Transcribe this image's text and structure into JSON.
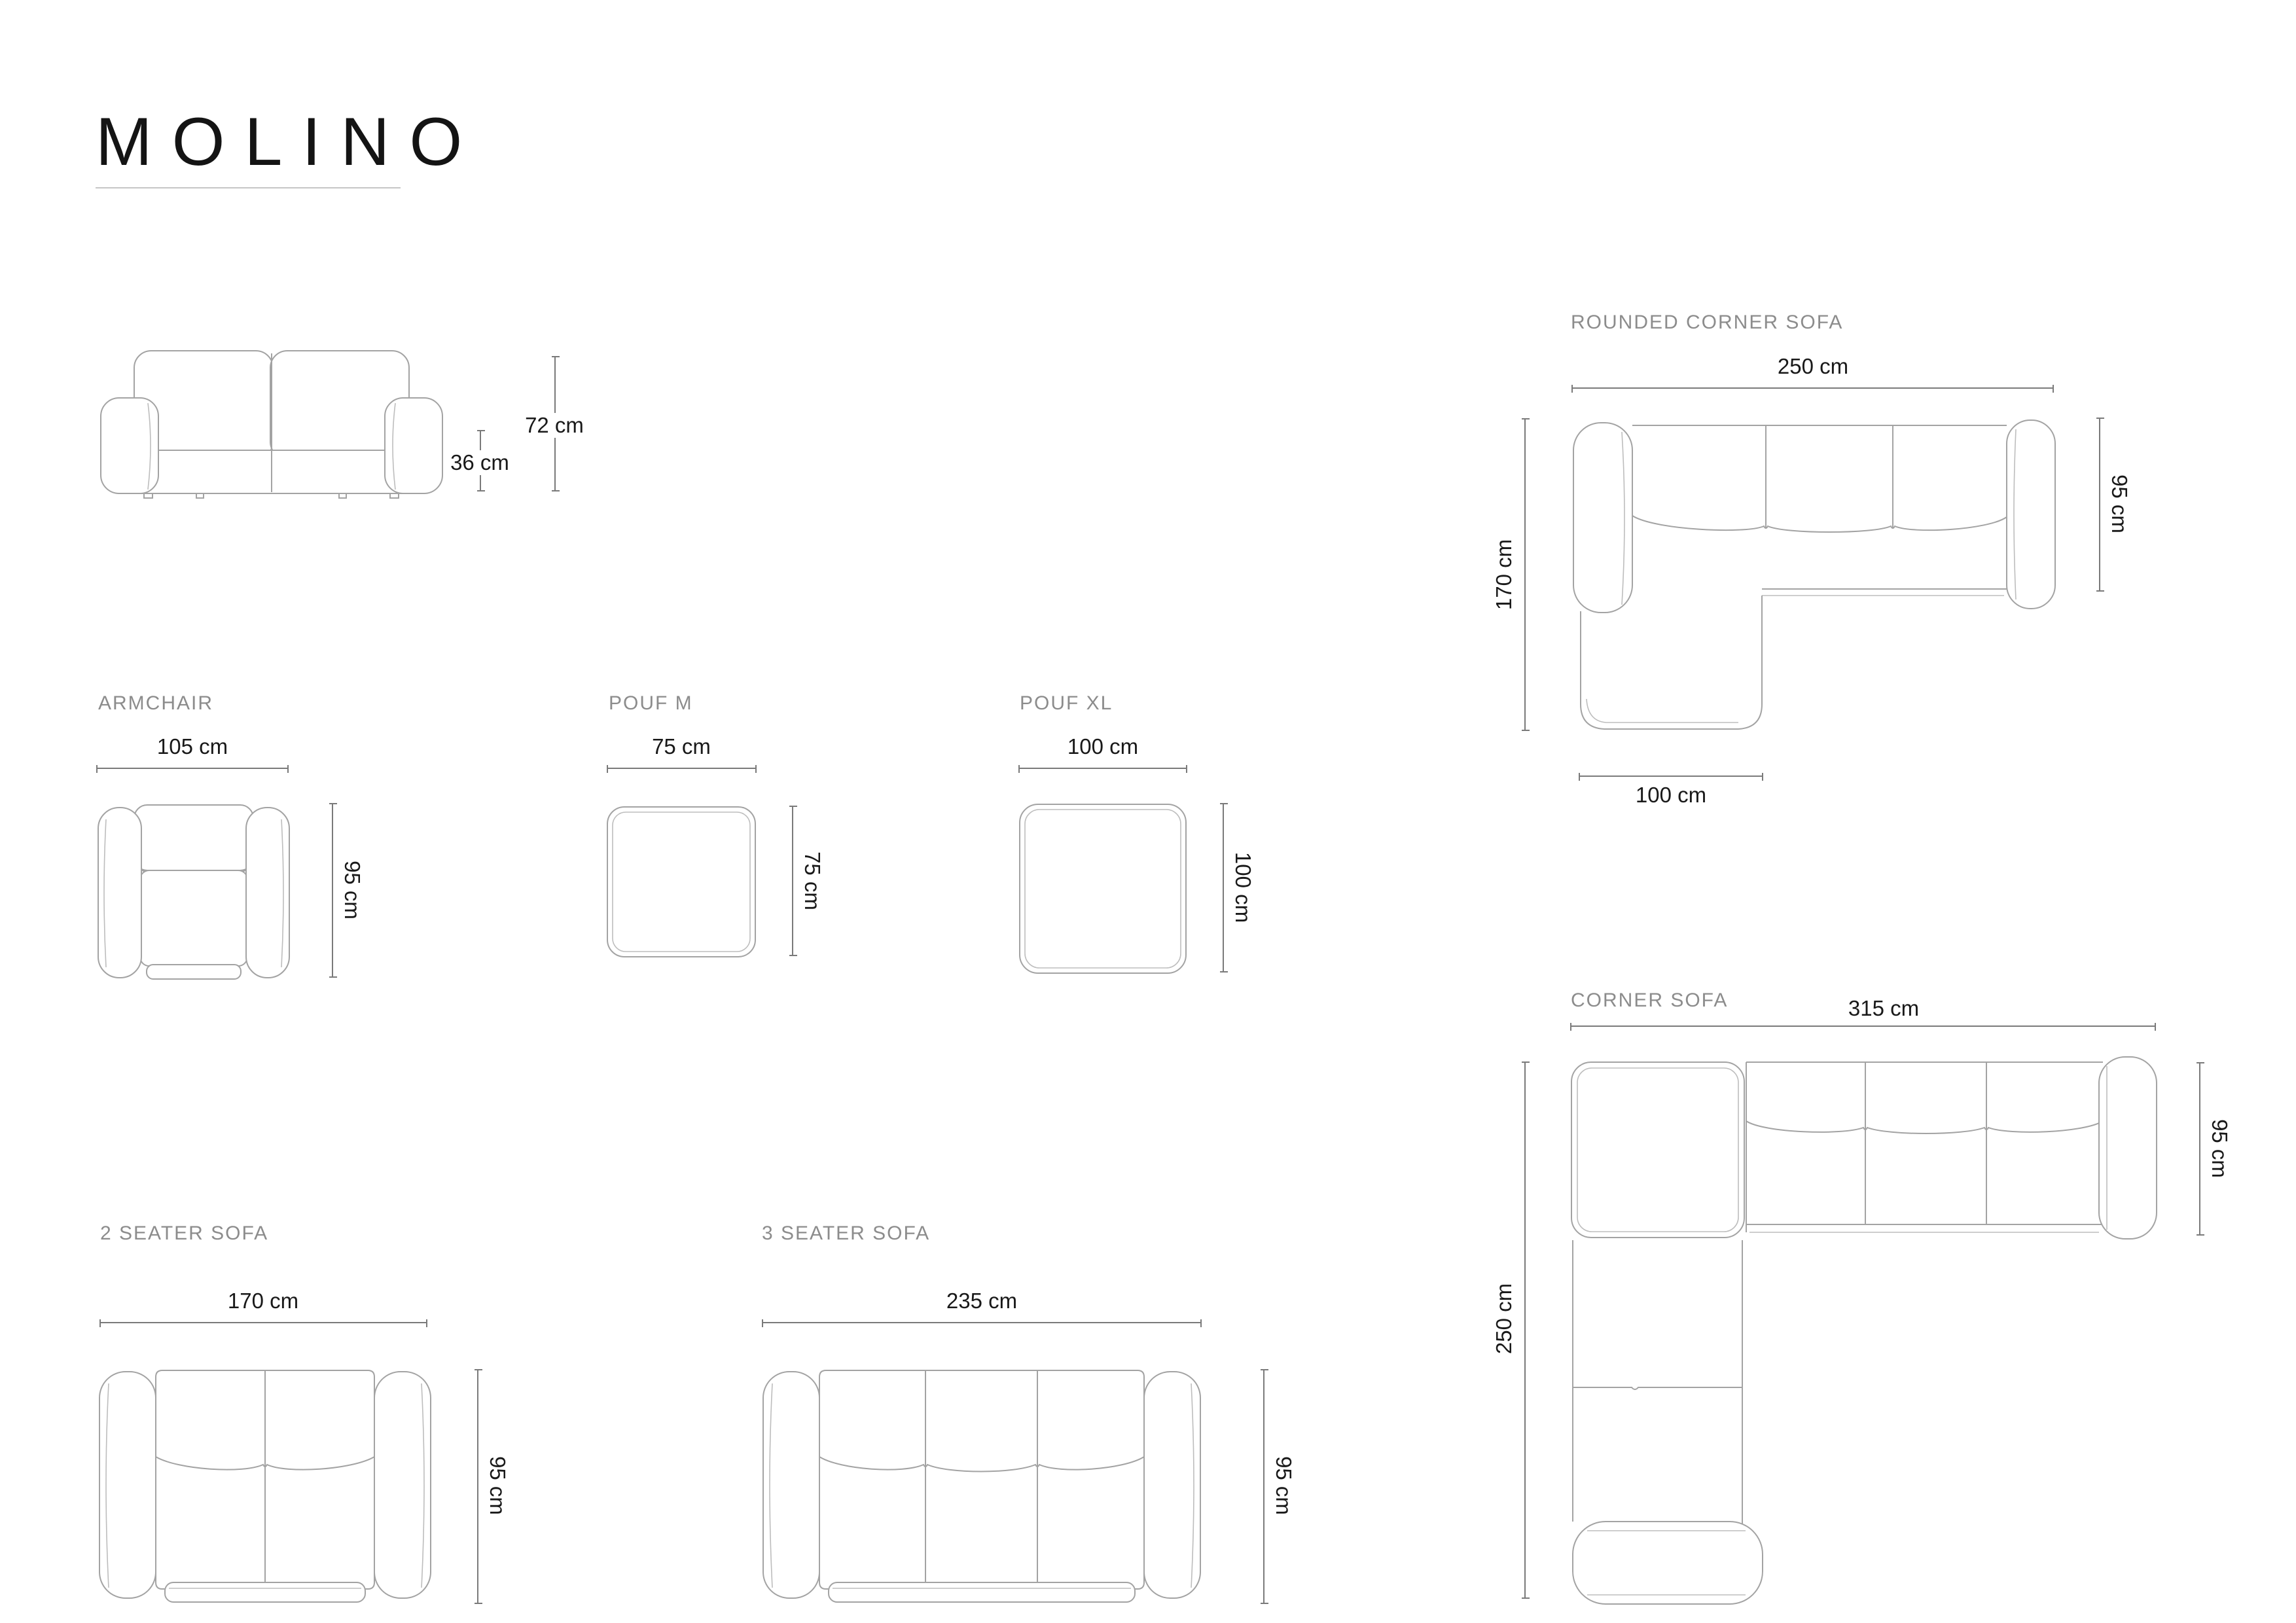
{
  "title": "MOLINO",
  "products": {
    "front_view": {
      "height": "72 cm",
      "seat_height": "36 cm"
    },
    "armchair": {
      "label": "ARMCHAIR",
      "width": "105 cm",
      "depth": "95 cm"
    },
    "pouf_m": {
      "label": "POUF M",
      "width": "75 cm",
      "depth": "75 cm"
    },
    "pouf_xl": {
      "label": "POUF XL",
      "width": "100 cm",
      "depth": "100 cm"
    },
    "rounded_corner_sofa": {
      "label": "ROUNDED CORNER SOFA",
      "width": "250 cm",
      "depth_left": "170 cm",
      "depth_right": "95 cm",
      "chaise_width": "100 cm"
    },
    "corner_sofa": {
      "label": "CORNER SOFA",
      "width": "315 cm",
      "depth_left": "250 cm",
      "depth_right": "95 cm"
    },
    "two_seater": {
      "label": "2 SEATER SOFA",
      "width": "170 cm",
      "depth": "95 cm"
    },
    "three_seater": {
      "label": "3 SEATER SOFA",
      "width": "235 cm",
      "depth": "95 cm"
    }
  }
}
